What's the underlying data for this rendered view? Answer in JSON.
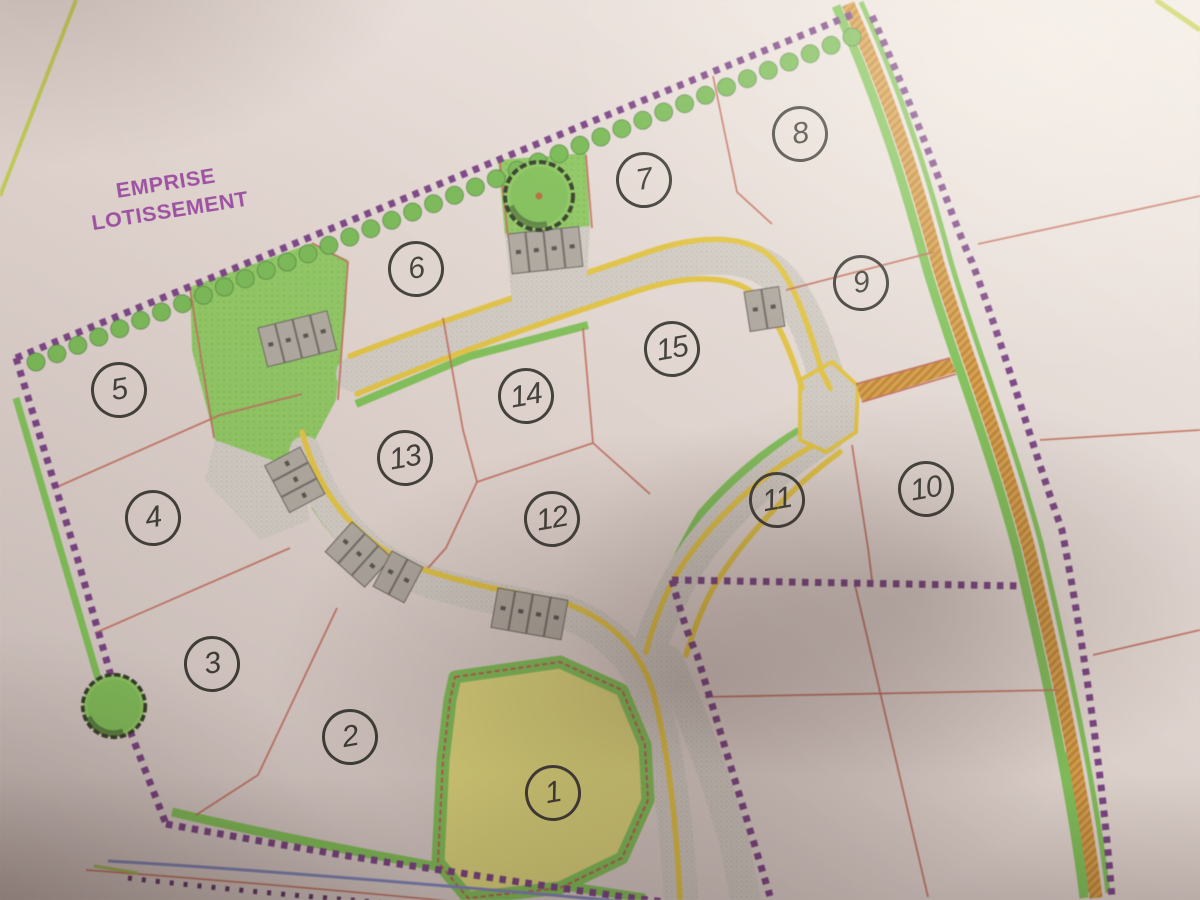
{
  "plan": {
    "title": {
      "line1": "EMPRISE",
      "line2": "LOTISSEMENT"
    },
    "lots": [
      {
        "number": "1",
        "x": 553,
        "y": 793
      },
      {
        "number": "2",
        "x": 350,
        "y": 737
      },
      {
        "number": "3",
        "x": 212,
        "y": 664
      },
      {
        "number": "4",
        "x": 153,
        "y": 518
      },
      {
        "number": "5",
        "x": 119,
        "y": 390
      },
      {
        "number": "6",
        "x": 416,
        "y": 269
      },
      {
        "number": "7",
        "x": 644,
        "y": 180
      },
      {
        "number": "8",
        "x": 800,
        "y": 134
      },
      {
        "number": "9",
        "x": 861,
        "y": 283
      },
      {
        "number": "10",
        "x": 926,
        "y": 489
      },
      {
        "number": "11",
        "x": 777,
        "y": 500
      },
      {
        "number": "12",
        "x": 552,
        "y": 519
      },
      {
        "number": "13",
        "x": 405,
        "y": 458
      },
      {
        "number": "14",
        "x": 526,
        "y": 396
      },
      {
        "number": "15",
        "x": 672,
        "y": 349
      }
    ],
    "colors": {
      "boundary_purple": "#7c3e8a",
      "hedge_green": "#74c04c",
      "area_green": "#8ccf5a",
      "strip_green": "#7cc84f",
      "road_gray": "#d8d3ca",
      "road_edge_yellow": "#ecc935",
      "highway_orange": "#e2a33e",
      "lot_line_red": "#cb6a58",
      "lot1_yellow": "#e6df76",
      "title_purple": "#9d4ba5",
      "circle_ink": "#3b3a35",
      "parking_gray": "#b2aca2",
      "stream_blue": "#7d86c4",
      "dot_line_purple": "#5c2e66",
      "corner_line_chartreuse": "#c6d348"
    }
  }
}
